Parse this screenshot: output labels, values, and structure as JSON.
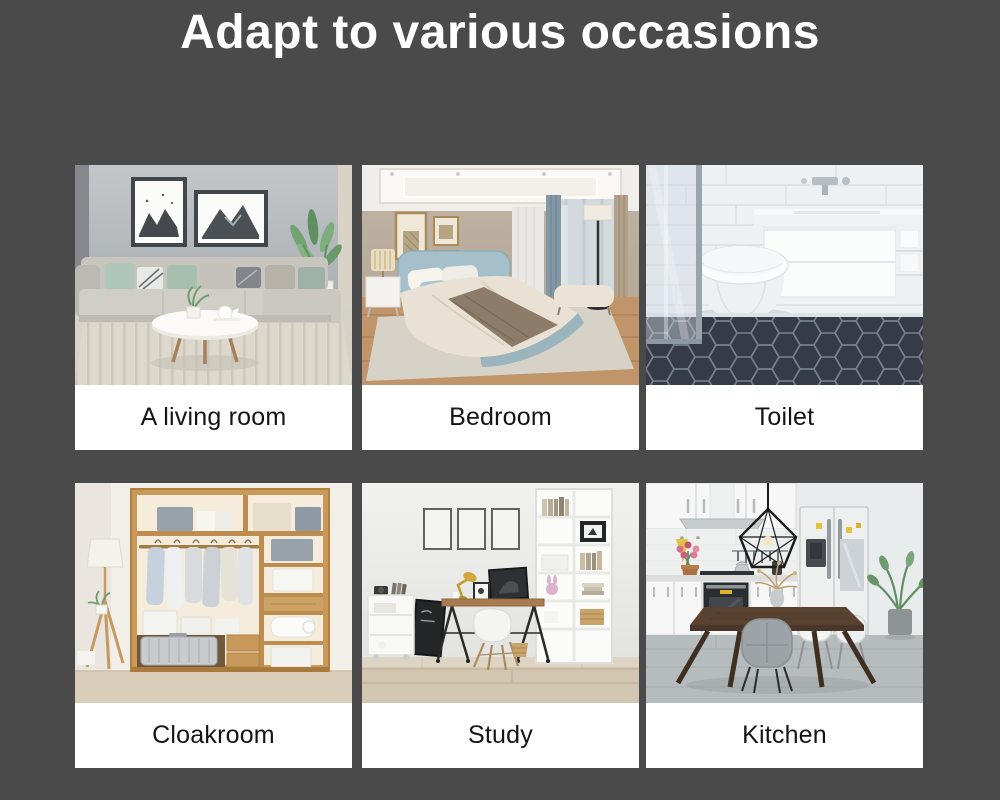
{
  "page": {
    "title": "Adapt to various occasions",
    "background_color": "#4a4a4a",
    "title_color": "#ffffff"
  },
  "card_style": {
    "background": "#ffffff",
    "label_color": "#141414"
  },
  "cards": [
    {
      "id": "living-room",
      "label": "A living room"
    },
    {
      "id": "bedroom",
      "label": "Bedroom"
    },
    {
      "id": "toilet",
      "label": "Toilet"
    },
    {
      "id": "cloakroom",
      "label": "Cloakroom"
    },
    {
      "id": "study",
      "label": "Study"
    },
    {
      "id": "kitchen",
      "label": "Kitchen"
    }
  ]
}
